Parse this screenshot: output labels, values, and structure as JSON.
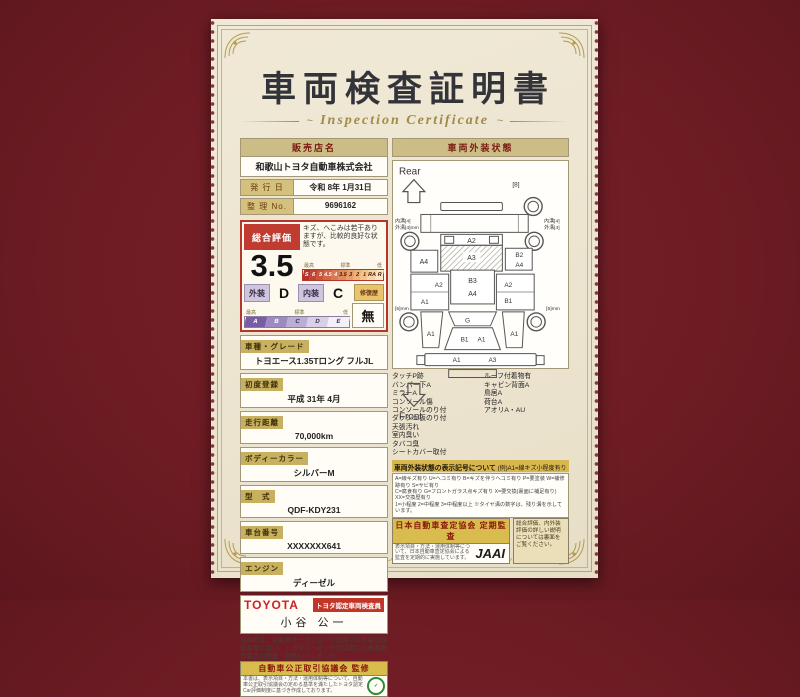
{
  "title": {
    "main": "車両検査証明書",
    "sub": "Inspection Certificate"
  },
  "dealer": {
    "label": "販売店名",
    "name": "和歌山トヨタ自動車株式会社"
  },
  "issue_date": {
    "label": "発 行 日",
    "value": "令和 8年 1月31日"
  },
  "ref_no": {
    "label": "整 理 No.",
    "value": "9696162"
  },
  "rating": {
    "overall_label": "総合評価",
    "overall_value": "3.5",
    "comment": "キズ、へこみは若干ありますが、比較的良好な状態です。",
    "scale_labels": {
      "high": "最高",
      "mid": "標準",
      "low": "低"
    },
    "scale_numeric": [
      "S",
      "6",
      "5",
      "4.5",
      "4",
      "3.5",
      "3",
      "2",
      "1",
      "RA",
      "R"
    ],
    "exterior_label": "外装",
    "exterior_value": "D",
    "interior_label": "内装",
    "interior_value": "C",
    "repair_label": "修復歴",
    "repair_value": "無",
    "scale_letter": [
      "A",
      "B",
      "C",
      "D",
      "E"
    ]
  },
  "fields": [
    {
      "label": "車種・グレード",
      "value": "トヨエース1.35Tロング フルJL"
    },
    {
      "label": "初度登録",
      "value": "平成 31年 4月"
    },
    {
      "label": "走行距離",
      "value": "70,000km"
    },
    {
      "label": "ボディーカラー",
      "value": "シルバーM"
    },
    {
      "label": "型　式",
      "value": "QDF-KDY231"
    },
    {
      "label": "車台番号",
      "value": "XXXXXXX641"
    },
    {
      "label": "エンジン",
      "value": "ディーゼル"
    }
  ],
  "inspector": {
    "brand": "TOYOTA",
    "badge": "トヨタ認定車両検査員",
    "name": "小谷 公一"
  },
  "disclaimer": "当車両は、自動車オークションで適用される車両評価基準に沿い、トヨタユーゼックが認定した検査員が厳正に検査・評価いたしました。",
  "exterior_panel": {
    "header": "車両外装状態",
    "rear_label": "Rear",
    "front_label": "Front",
    "marks": {
      "rear_gate": "A2",
      "bed": "A3",
      "bed_left": "A4",
      "bed_right_top": "B2",
      "bed_right": "A4",
      "roof": "B3",
      "roof_lower": "A4",
      "side_left_upper": "A2",
      "side_left_lower": "A1",
      "side_right_upper": "A2",
      "side_right_lower": "B1",
      "windshield": "G",
      "hood_left": "B1",
      "hood_right": "A1",
      "fender_left": "A1",
      "fender_right": "A1",
      "bumper_left": "A1",
      "bumper_right": "A3"
    },
    "tire_notes": {
      "rear_right_top": "[8]",
      "rear_left_line1": "内溝[4]",
      "rear_left_line2": "外溝[4]mm",
      "rear_right_line1": "内溝[4]",
      "rear_right_line2": "外溝[4]",
      "front_left": "[5]mm",
      "front_right": "[5]mm"
    },
    "notes_left": [
      "タッチP跡",
      "バンパー下A",
      "ミラーA",
      "コンソール傷",
      "コンソールのり付",
      "ダッシュ板のり付",
      "天張汚れ",
      "室内臭い",
      "タバコ臭",
      "シートカバー取付"
    ],
    "notes_right": [
      "ルーフ付着物有",
      "キャビン背面A",
      "鳥居A",
      "荷台A",
      "アオリA・AU"
    ],
    "legend_title": "車両外装状態の表示記号について",
    "legend_example": "(例)A1=線キズ小程度有り",
    "legend_lines": [
      "A=線キズ有り U=ヘコミ有り B=キズを伴うヘコミ有り P=要塗装 W=補修跡有り S=サビ有り",
      "C=腐食有り G=フロントガラス点キズ有り X=要交換(裏面に補足有り) XX=交換歴有り",
      "1=小程度 2=中程度 3=中程度以上 ※タイヤ溝の数字は、残り溝を示しています。"
    ]
  },
  "footer": {
    "fair_trade": {
      "header": "自動車公正取引協議会 監修",
      "text": "本書は、表示項目・方法・運用体制等について、自動車公正取引協議会の定める基準を満たしたトヨタ認定Car評価制度に基づき作成しております。"
    },
    "jaai": {
      "header": "日本自動車査定協会 定期監査",
      "text": "表示項目・方法・運用体制等について、日本自動車査定協会による監査を定期的に実施しています。",
      "logo": "JAAI"
    },
    "back_note": "総合評価、内外装評価の詳しい説明については裏面をご覧ください。"
  }
}
